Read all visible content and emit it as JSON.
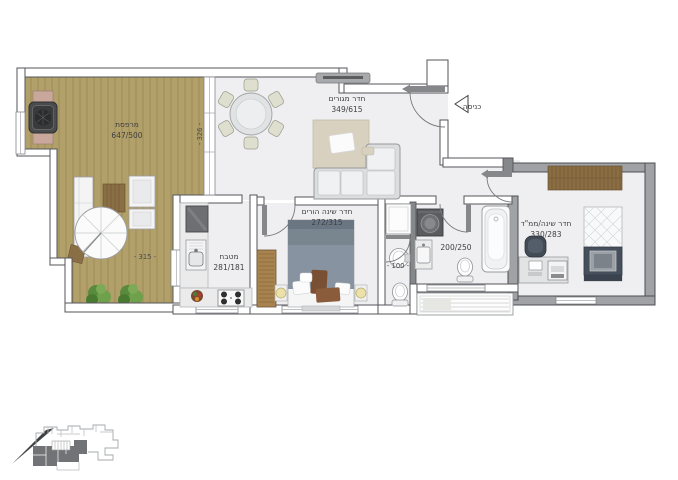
{
  "rooms": {
    "balcony": {
      "name": "מרפסת",
      "size": "647/500"
    },
    "living_room": {
      "name": "חדר מגורים",
      "size": "349/615"
    },
    "kitchen": {
      "name": "מטבח",
      "size": "281/181"
    },
    "master_bedroom": {
      "name": "חדר שינה הורים",
      "size": "272/315"
    },
    "bathroom": {
      "size": "200/250"
    },
    "wc": {
      "size": "- 100 -"
    },
    "safe_room": {
      "name": "חדר שינה/ממ\"ד",
      "size": "330/283"
    }
  },
  "entrance": {
    "label": "כניסה"
  },
  "dimensions": {
    "balcony_width": "- 315 -",
    "balcony_depth": "- 326 -"
  },
  "colors": {
    "deck_wood": "#b2a06a",
    "deck_plank_line": "#95824f",
    "wood_accent": "#8a6d43",
    "wall_outline": "#54565a",
    "safe_room_wall": "#a0a2a5",
    "floor": "#efeff1",
    "rug": "#d9d1c0",
    "plant_green": "#5a8a3c",
    "lamp_yellow": "#ece2a9",
    "bed_gray": "#8793a0",
    "bed_navy": "#46505c",
    "keyplan_highlight": "#717376"
  }
}
